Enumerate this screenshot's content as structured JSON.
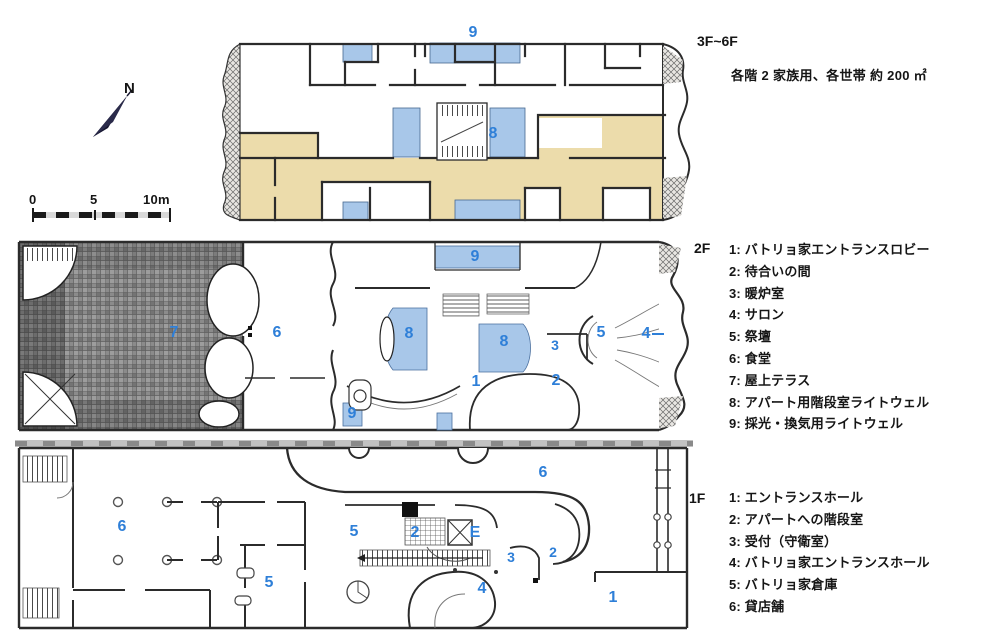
{
  "colors": {
    "light_well_blue": "#a8c7e9",
    "apartment_tan": "#ecdcab",
    "label_blue": "#2e7fd8",
    "wall_dark": "#2b2b2b"
  },
  "compass": {
    "label": "N"
  },
  "scale_bar": {
    "tick_0": "0",
    "tick_5": "5",
    "tick_10": "10m"
  },
  "floors": {
    "upper": {
      "title": "3F~6F",
      "note": "各階 2 家族用、各世帯 約 200 ㎡",
      "labels": [
        {
          "text": "9"
        },
        {
          "text": "8"
        }
      ]
    },
    "second": {
      "title": "2F",
      "legend": [
        "1: バトリョ家エントランスロビー",
        "2: 待合いの間",
        "3: 暖炉室",
        "4: サロン",
        "5: 祭壇",
        "6: 食堂",
        "7: 屋上テラス",
        "8: アパート用階段室ライトウェル",
        "9: 採光・換気用ライトウェル"
      ],
      "labels": [
        {
          "text": "9"
        },
        {
          "text": "8"
        },
        {
          "text": "8"
        },
        {
          "text": "7"
        },
        {
          "text": "6"
        },
        {
          "text": "3"
        },
        {
          "text": "5"
        },
        {
          "text": "4"
        },
        {
          "text": "1"
        },
        {
          "text": "2"
        },
        {
          "text": "9"
        }
      ]
    },
    "first": {
      "title": "1F",
      "legend": [
        "1: エントランスホール",
        "2: アパートへの階段室",
        "3: 受付（守衛室）",
        "4: バトリョ家エントランスホール",
        "5: バトリョ家倉庫",
        "6: 貸店舗"
      ],
      "labels": [
        {
          "text": "6"
        },
        {
          "text": "6"
        },
        {
          "text": "5"
        },
        {
          "text": "2"
        },
        {
          "text": "E"
        },
        {
          "text": "3"
        },
        {
          "text": "2"
        },
        {
          "text": "4"
        },
        {
          "text": "5"
        },
        {
          "text": "1"
        }
      ]
    }
  }
}
